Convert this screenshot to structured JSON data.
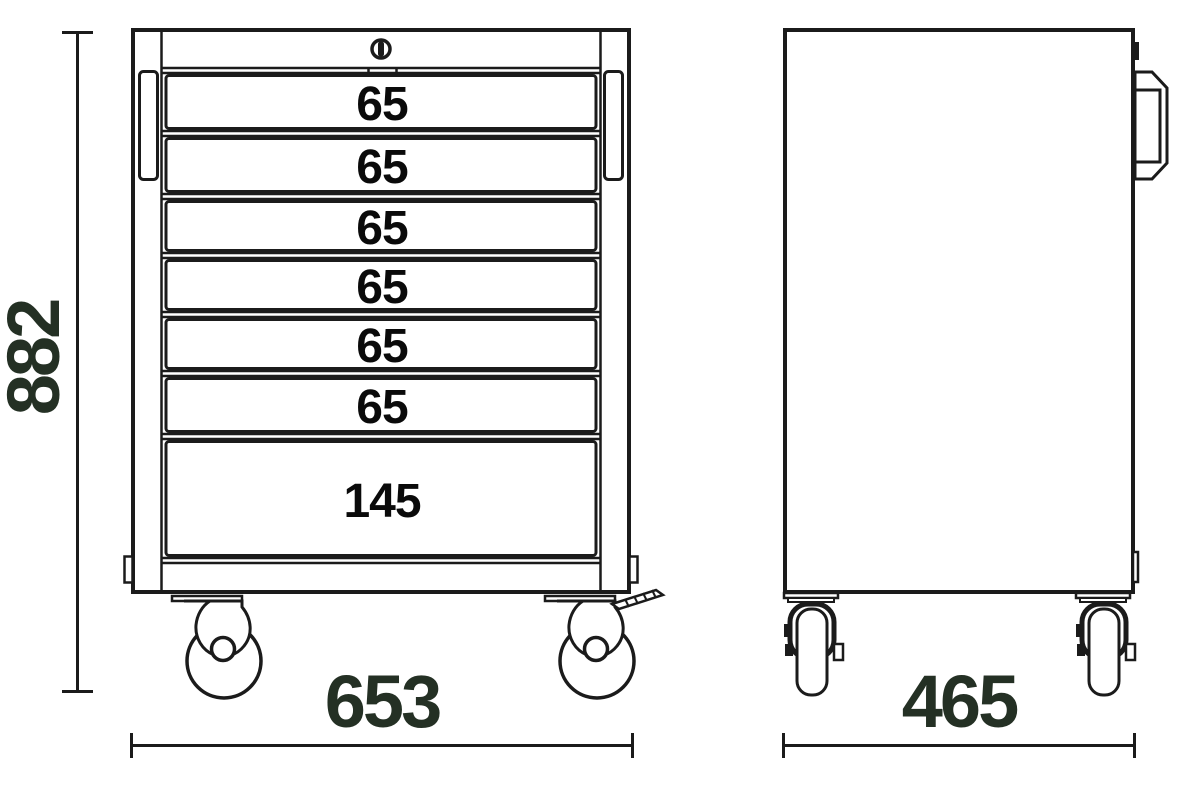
{
  "diagram_title": "tool-trolley-dimension-drawing",
  "views": {
    "front": {
      "drawers": [
        {
          "label": "65"
        },
        {
          "label": "65"
        },
        {
          "label": "65"
        },
        {
          "label": "65"
        },
        {
          "label": "65"
        },
        {
          "label": "65"
        },
        {
          "label": "145"
        }
      ]
    },
    "side": {}
  },
  "dimensions": {
    "height": "882",
    "width": "653",
    "depth": "465"
  },
  "icons": {
    "lock": "keyhole-circle",
    "caster": "swivel-caster-wheel",
    "brake": "caster-brake-lever",
    "handle": "side-carry-handle"
  },
  "colors": {
    "line": "#1b1b1b",
    "dimension_text": "#243024",
    "drawer_text": "#0a0a0a",
    "background": "#ffffff"
  }
}
